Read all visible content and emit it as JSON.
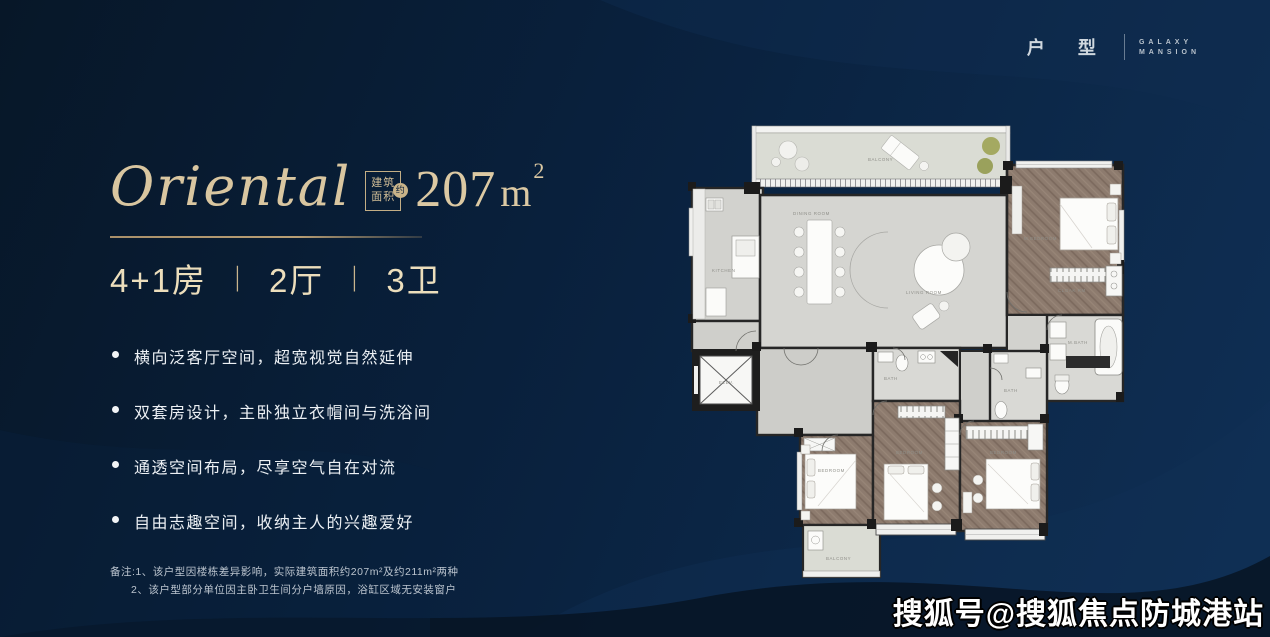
{
  "brand": {
    "category": "户 型",
    "name_line1": "GALAXY",
    "name_line2": "MANSION"
  },
  "unit": {
    "title": "Oriental",
    "area_label_top": "建筑",
    "area_label_bottom": "面积",
    "area_approx": "约",
    "area_value": "207",
    "area_unit": "m",
    "area_unit_sup": "2",
    "spec": [
      "4+1房",
      "2厅",
      "3卫"
    ],
    "spec_sep": "丨"
  },
  "features": [
    "横向泛客厅空间，超宽视觉自然延伸",
    "双套房设计，主卧独立衣帽间与洗浴间",
    "通透空间布局，尽享空气自在对流",
    "自由志趣空间，收纳主人的兴趣爱好"
  ],
  "notes": {
    "line1": "备注:1、该户型因楼栋差异影响，实际建筑面积约207m²及约211m²两种",
    "line2": "2、该户型部分单位因主卧卫生间分户墙原因，浴缸区域无安装窗户"
  },
  "watermark": "搜狐号@搜狐焦点防城港站",
  "colors": {
    "background": "#09203c",
    "accent_gold": "#d9c6a0",
    "divider_gold": "#ad9569",
    "text_white": "#ecf0f4",
    "plan_wall": "#1e1e1e",
    "plan_floor": "#d5d5d1",
    "plan_wood": "#8b7a6d",
    "plan_balcony": "#dadcd4"
  },
  "floorplan": {
    "labels": {
      "balcony": "BALCONY",
      "dining": "DINING ROOM",
      "living": "LIVING ROOM",
      "kitchen": "KITCHEN",
      "master_bedroom": "M.BEDROOM",
      "cloak": "CLOAK RM",
      "master_bath": "M.BATH",
      "bedroom": "BEDROOM",
      "bath": "BATH",
      "balcony_sw": "BALCONY",
      "elevator": "ELEV."
    }
  }
}
